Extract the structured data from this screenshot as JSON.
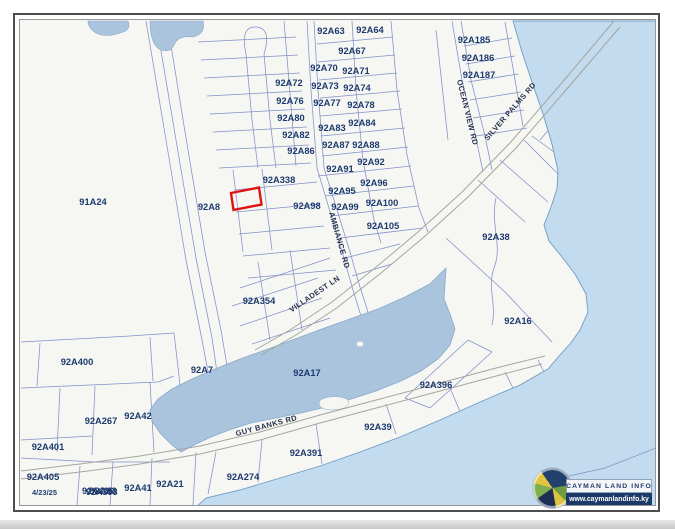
{
  "window": {
    "date_stamp": "4/23/25",
    "overlapping_labels": [
      "92A406",
      "92A398"
    ]
  },
  "logo": {
    "title": "CAYMAN LAND INFO",
    "url": "www.caymanlandinfo.ky"
  },
  "map": {
    "colors": {
      "land": "#f6f6f3",
      "sea": "#c2dbee",
      "pond": "#abc4dd",
      "parcel_line": "#8090c8",
      "road_line": "#a5a69e",
      "label": "#1d3a6e",
      "highlight": "#e11212"
    },
    "highlight_parcel": {
      "note": "red outlined parcel west of 92A338"
    },
    "parcel_labels": [
      {
        "text": "92A63",
        "x": 331,
        "y": 34
      },
      {
        "text": "92A64",
        "x": 370,
        "y": 33
      },
      {
        "text": "92A67",
        "x": 352,
        "y": 54
      },
      {
        "text": "92A70",
        "x": 324,
        "y": 71
      },
      {
        "text": "92A71",
        "x": 356,
        "y": 74
      },
      {
        "text": "92A72",
        "x": 289,
        "y": 86
      },
      {
        "text": "92A73",
        "x": 325,
        "y": 89
      },
      {
        "text": "92A74",
        "x": 357,
        "y": 91
      },
      {
        "text": "92A76",
        "x": 290,
        "y": 104
      },
      {
        "text": "92A77",
        "x": 327,
        "y": 106
      },
      {
        "text": "92A78",
        "x": 361,
        "y": 108
      },
      {
        "text": "92A80",
        "x": 291,
        "y": 121
      },
      {
        "text": "92A82",
        "x": 296,
        "y": 138
      },
      {
        "text": "92A83",
        "x": 332,
        "y": 131
      },
      {
        "text": "92A84",
        "x": 362,
        "y": 126
      },
      {
        "text": "92A86",
        "x": 301,
        "y": 154
      },
      {
        "text": "92A87",
        "x": 336,
        "y": 148
      },
      {
        "text": "92A88",
        "x": 366,
        "y": 148
      },
      {
        "text": "92A91",
        "x": 340,
        "y": 172
      },
      {
        "text": "92A92",
        "x": 371,
        "y": 165
      },
      {
        "text": "92A95",
        "x": 342,
        "y": 194
      },
      {
        "text": "92A96",
        "x": 374,
        "y": 186
      },
      {
        "text": "92A98",
        "x": 307,
        "y": 209
      },
      {
        "text": "92A99",
        "x": 345,
        "y": 210
      },
      {
        "text": "92A100",
        "x": 382,
        "y": 206
      },
      {
        "text": "92A105",
        "x": 383,
        "y": 229
      },
      {
        "text": "92A338",
        "x": 279,
        "y": 183
      },
      {
        "text": "92A185",
        "x": 474,
        "y": 43
      },
      {
        "text": "92A186",
        "x": 478,
        "y": 61
      },
      {
        "text": "92A187",
        "x": 479,
        "y": 78
      },
      {
        "text": "91A24",
        "x": 93,
        "y": 205
      },
      {
        "text": "92A8",
        "x": 209,
        "y": 210
      },
      {
        "text": "92A38",
        "x": 496,
        "y": 240
      },
      {
        "text": "92A16",
        "x": 518,
        "y": 324
      },
      {
        "text": "92A354",
        "x": 259,
        "y": 304
      },
      {
        "text": "92A7",
        "x": 202,
        "y": 373
      },
      {
        "text": "92A17",
        "x": 307,
        "y": 376
      },
      {
        "text": "92A400",
        "x": 77,
        "y": 365
      },
      {
        "text": "92A267",
        "x": 101,
        "y": 424
      },
      {
        "text": "92A42",
        "x": 138,
        "y": 419
      },
      {
        "text": "92A401",
        "x": 48,
        "y": 450
      },
      {
        "text": "92A405",
        "x": 43,
        "y": 480
      },
      {
        "text": "92A23",
        "x": 103,
        "y": 494
      },
      {
        "text": "92A41",
        "x": 138,
        "y": 491
      },
      {
        "text": "92A21",
        "x": 170,
        "y": 487
      },
      {
        "text": "92A274",
        "x": 243,
        "y": 480
      },
      {
        "text": "92A391",
        "x": 306,
        "y": 456
      },
      {
        "text": "92A39",
        "x": 378,
        "y": 430
      },
      {
        "text": "92A396",
        "x": 436,
        "y": 388
      }
    ],
    "road_labels": [
      {
        "text": "OCEAN VIEW RD",
        "x": 465,
        "y": 113,
        "rot": 76
      },
      {
        "text": "SILVER PALMS RD",
        "x": 512,
        "y": 113,
        "rot": -49
      },
      {
        "text": "AMBIANCE RD",
        "x": 337,
        "y": 241,
        "rot": 74
      },
      {
        "text": "VILLADEST LN",
        "x": 316,
        "y": 296,
        "rot": -34
      },
      {
        "text": "GUY BANKS RD",
        "x": 267,
        "y": 428,
        "rot": -15
      }
    ]
  }
}
